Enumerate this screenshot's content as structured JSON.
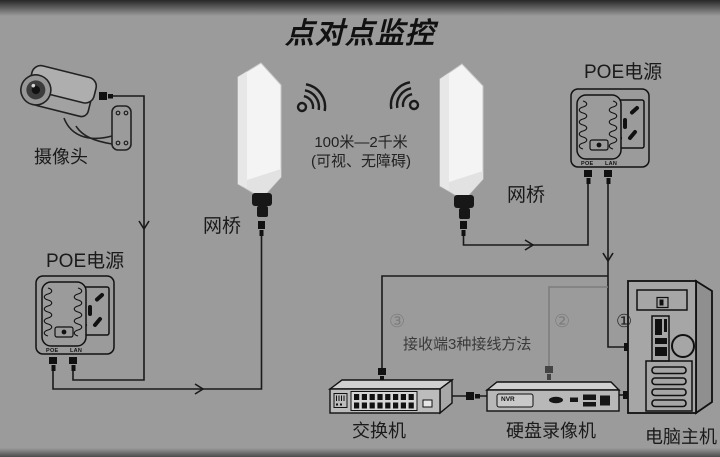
{
  "title": "点对点监控",
  "colors": {
    "background": "#9b9b9b",
    "line": "#1a1a1a",
    "secondary_line": "#7d7d7d",
    "device_white": "#f4f4f4"
  },
  "camera": {
    "label": "摄像头",
    "icon": "cctv-camera-icon"
  },
  "poe_left": {
    "label": "POE电源",
    "port_left": "POE",
    "port_right": "LAN",
    "icon": "poe-injector-icon"
  },
  "poe_right": {
    "label": "POE电源",
    "port_left": "POE",
    "port_right": "LAN",
    "icon": "poe-injector-icon"
  },
  "bridge_left": {
    "label": "网桥",
    "icon": "wireless-bridge-icon"
  },
  "bridge_right": {
    "label": "网桥",
    "icon": "wireless-bridge-icon"
  },
  "wireless": {
    "distance": "100米—2千米",
    "condition": "(可视、无障碍)",
    "icon": "wifi-signal-icon"
  },
  "receiving": {
    "note": "接收端3种接线方法",
    "method_1": "①",
    "method_2": "②",
    "method_3": "③"
  },
  "switch": {
    "label": "交换机",
    "icon": "network-switch-icon"
  },
  "dvr": {
    "label": "硬盘录像机",
    "badge": "NVR",
    "icon": "dvr-recorder-icon"
  },
  "pc": {
    "label": "电脑主机",
    "icon": "desktop-tower-icon"
  }
}
